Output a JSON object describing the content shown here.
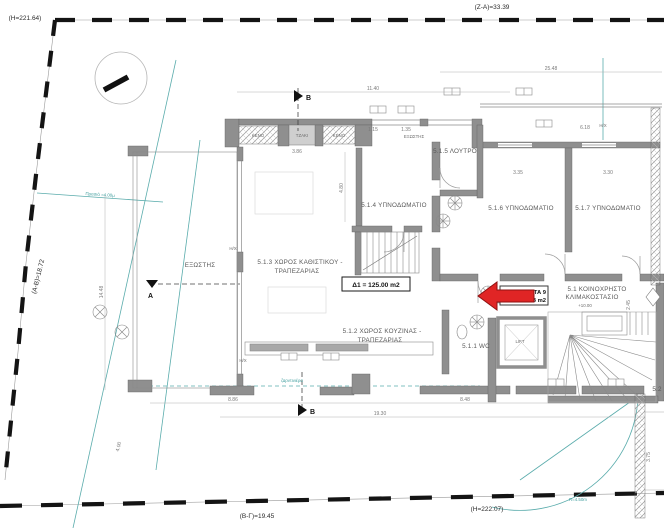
{
  "boundary": {
    "top_left_elevation": "(H=221.64)",
    "top_length": "(Z-A)=33.39",
    "left_length": "(A-B)=18.72",
    "bottom_length": "(B-Γ)=19.45",
    "bottom_right_elevation": "(H=222.07)"
  },
  "rooms": {
    "living_line1": "5.1.3 ΧΩΡΟΣ ΚΑΘΙΣΤΙΚΟΥ -",
    "living_line2": "ΤΡΑΠΕΖΑΡΙΑΣ",
    "kitchen_line1": "5.1.2 ΧΩΡΟΣ ΚΟΥΖΙΝΑΣ -",
    "kitchen_line2": "ΤΡΑΠΕΖΑΡΙΑΣ",
    "bedroom4": "5.1.4 ΥΠΝΟΔΩΜΑΤΙΟ",
    "bathroom5": "5.1.5 ΛΟΥΤΡΟ",
    "bedroom6": "5.1.6 ΥΠΝΟΔΩΜΑΤΙΟ",
    "bedroom7": "5.1.7 ΥΠΝΟΔΩΜΑΤΙΟ",
    "wc": "5.1.1 WC",
    "stair_line1": "5.1 ΚΟΙΝΟΧΡΗΣΤΟ",
    "stair_line2": "ΚΛΙΜΑΚΟΣΤΑΣΙΟ",
    "lift": "LIFT",
    "unit_52": "5.2"
  },
  "annotations": {
    "area_box": "Δ1 = 125.00 m2",
    "void": "ΚΕΝΟ",
    "fireplace": "ΤΖΑΚΙ",
    "balcony": "ΕΞΩΣΤΗΣ",
    "semi_open": "Η/Χ",
    "planter": "ζαρντινιέρα",
    "setback": "Πρασιά =4.00μ",
    "stair_elevation": "+10.00",
    "entry_tag_line1": "ΣΤΑ 9",
    "entry_tag_line2": "03 m2",
    "radius": "R=4.50m",
    "section_a": "A",
    "section_b": "B"
  },
  "dimensions": {
    "d1": "25.48",
    "d2": "11.40",
    "d3": "19.30",
    "d4": "8.86",
    "d5": "8.48",
    "d6": "3.86",
    "d7": "1.15",
    "d8": "1.35",
    "d9": "3.35",
    "d10": "3.30",
    "d11": "6.18",
    "d12": "4.80",
    "d13": "14.48",
    "d14": "4.00",
    "d15": "2.45",
    "d16": "3.75"
  },
  "colors": {
    "wall": "#8f8f8f",
    "teal_accent": "#4aa3a3",
    "arrow_red": "#e02525",
    "boundary_black": "#141414"
  }
}
